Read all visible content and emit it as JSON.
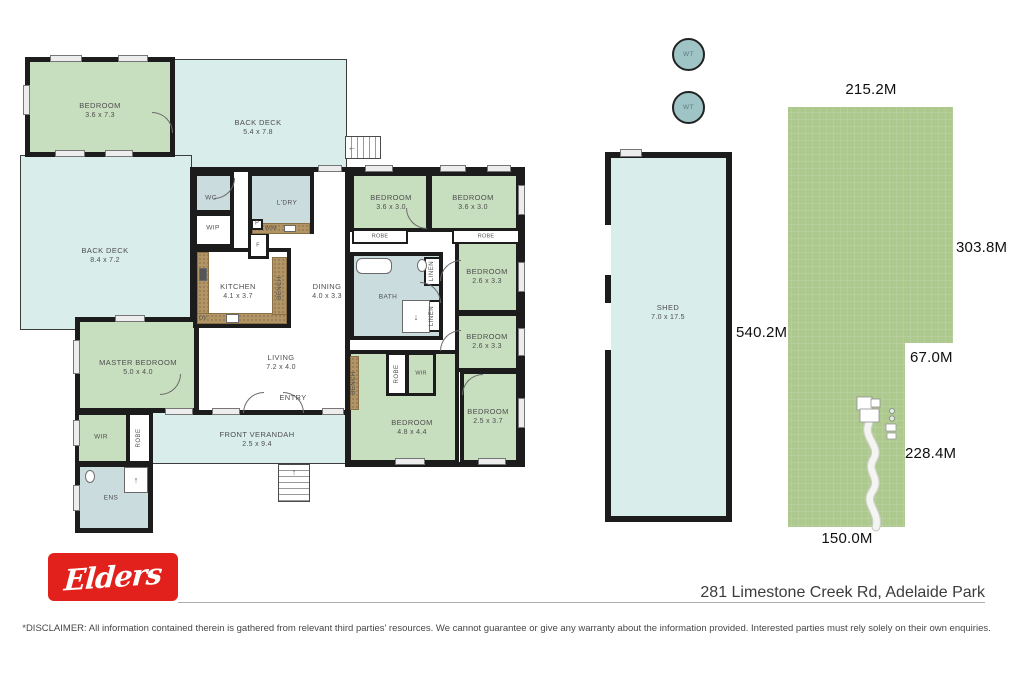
{
  "plan": {
    "rooms": {
      "bedroom_tl": {
        "name": "BEDROOM",
        "dims": "3.6 x 7.3"
      },
      "back_deck_top": {
        "name": "BACK DECK",
        "dims": "5.4 x 7.8"
      },
      "back_deck_left": {
        "name": "BACK DECK",
        "dims": "8.4 x 7.2"
      },
      "wc": {
        "name": "WC"
      },
      "wip": {
        "name": "WIP"
      },
      "ldry": {
        "name": "L'DRY"
      },
      "wm": {
        "name": "W/M"
      },
      "fridge": {
        "name": "F"
      },
      "pantry": {
        "name": "P"
      },
      "kitchen": {
        "name": "KITCHEN",
        "dims": "4.1 x 3.7"
      },
      "oven": {
        "name": "OV"
      },
      "bench_kitchen": {
        "name": "BENCH"
      },
      "dining": {
        "name": "DINING",
        "dims": "4.0 x 3.3"
      },
      "living": {
        "name": "LIVING",
        "dims": "7.2 x 4.0"
      },
      "entry": {
        "name": "ENTRY"
      },
      "master": {
        "name": "MASTER BEDROOM",
        "dims": "5.0 x 4.0"
      },
      "wir_master": {
        "name": "WIR"
      },
      "robe_master": {
        "name": "ROBE"
      },
      "ens": {
        "name": "ENS"
      },
      "verandah": {
        "name": "FRONT VERANDAH",
        "dims": "2.5 x 9.4"
      },
      "bed1": {
        "name": "BEDROOM",
        "dims": "3.6 x 3.0"
      },
      "robe1": {
        "name": "ROBE"
      },
      "bed2": {
        "name": "BEDROOM",
        "dims": "3.6 x 3.0"
      },
      "robe2": {
        "name": "ROBE"
      },
      "bath": {
        "name": "BATH"
      },
      "linen1": {
        "name": "LINEN"
      },
      "linen2": {
        "name": "LINEN"
      },
      "bed3": {
        "name": "BEDROOM",
        "dims": "2.6 x 3.3"
      },
      "bed4": {
        "name": "BEDROOM",
        "dims": "2.6 x 3.3"
      },
      "bed5": {
        "name": "BEDROOM",
        "dims": "4.8 x 4.4"
      },
      "robe3": {
        "name": "ROBE"
      },
      "wir2": {
        "name": "WIR"
      },
      "bench_hall": {
        "name": "BENCH"
      },
      "bed6": {
        "name": "BEDROOM",
        "dims": "2.5 x 3.7"
      },
      "shed": {
        "name": "SHED",
        "dims": "7.0 x 17.5"
      }
    },
    "tank_label": "WT"
  },
  "land": {
    "top": "215.2M",
    "right": "303.8M",
    "notch_top": "67.0M",
    "notch_right": "228.4M",
    "bottom": "150.0M",
    "shed_frontage": "540.2M"
  },
  "footer": {
    "brand": "Elders",
    "address": "281 Limestone Creek Rd, Adelaide Park",
    "disclaimer": "*DISCLAIMER: All information contained therein is gathered from relevant third parties' resources. We cannot guarantee or give any warranty about the information provided. Interested parties must rely solely on their own enquiries."
  },
  "colors": {
    "wall": "#1c1c1c",
    "deck": "#d9edea",
    "bedroom": "#c8dfbf",
    "wet_area": "#cbdcde",
    "land": "#adc98e",
    "tank": "#9fc4c5",
    "bench": "#b19566",
    "brand_red": "#e2211c"
  }
}
